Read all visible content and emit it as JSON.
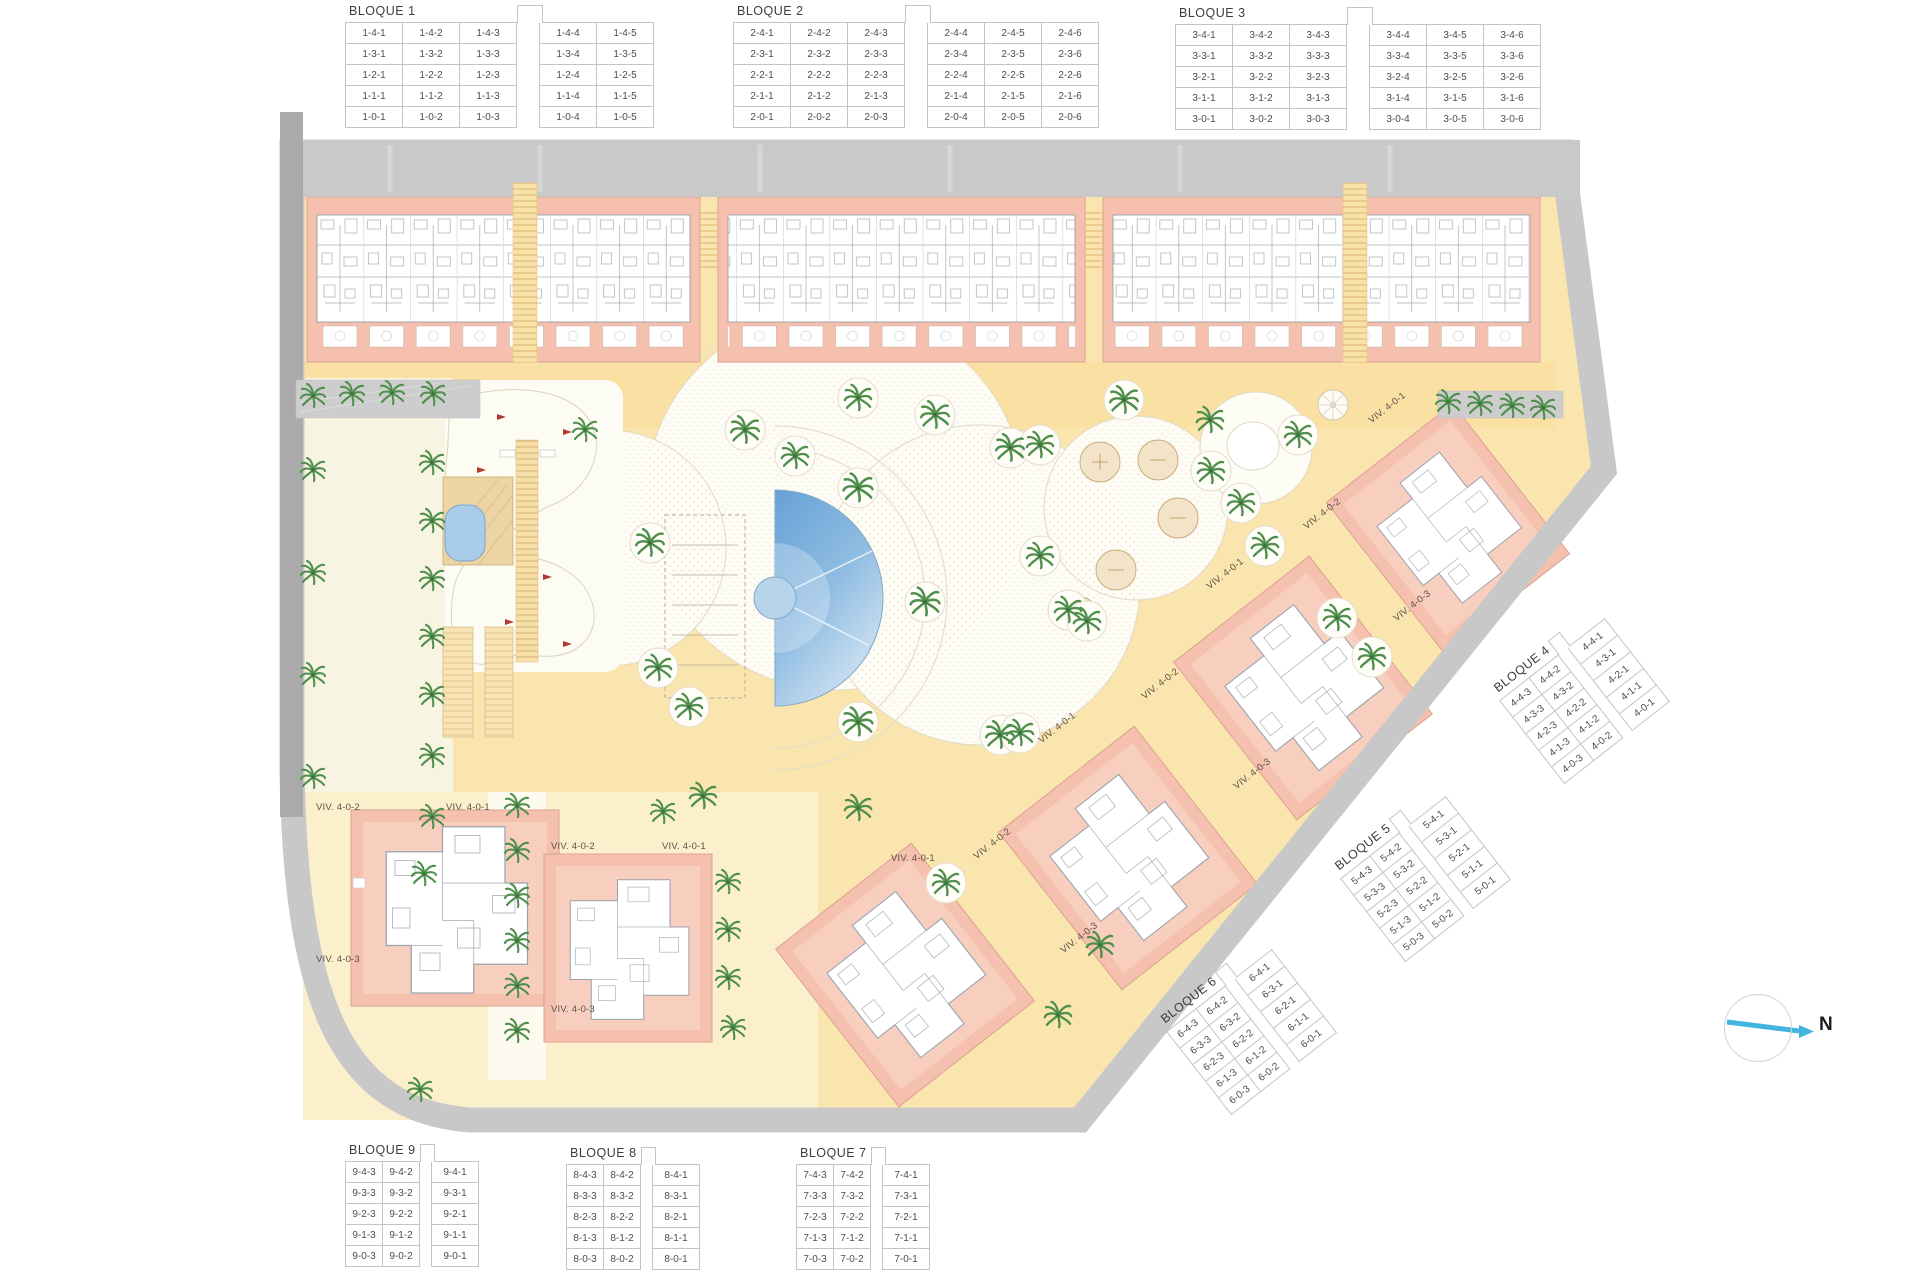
{
  "compass": {
    "label": "N",
    "icon": "north-arrow-icon"
  },
  "tables": [
    {
      "id": "bloque-1",
      "title": "BLOQUE 1",
      "gap_after": 3,
      "rows": [
        [
          "1-4-1",
          "1-4-2",
          "1-4-3",
          "1-4-4",
          "1-4-5"
        ],
        [
          "1-3-1",
          "1-3-2",
          "1-3-3",
          "1-3-4",
          "1-3-5"
        ],
        [
          "1-2-1",
          "1-2-2",
          "1-2-3",
          "1-2-4",
          "1-2-5"
        ],
        [
          "1-1-1",
          "1-1-2",
          "1-1-3",
          "1-1-4",
          "1-1-5"
        ],
        [
          "1-0-1",
          "1-0-2",
          "1-0-3",
          "1-0-4",
          "1-0-5"
        ]
      ]
    },
    {
      "id": "bloque-2",
      "title": "BLOQUE 2",
      "gap_after": 3,
      "rows": [
        [
          "2-4-1",
          "2-4-2",
          "2-4-3",
          "2-4-4",
          "2-4-5",
          "2-4-6"
        ],
        [
          "2-3-1",
          "2-3-2",
          "2-3-3",
          "2-3-4",
          "2-3-5",
          "2-3-6"
        ],
        [
          "2-2-1",
          "2-2-2",
          "2-2-3",
          "2-2-4",
          "2-2-5",
          "2-2-6"
        ],
        [
          "2-1-1",
          "2-1-2",
          "2-1-3",
          "2-1-4",
          "2-1-5",
          "2-1-6"
        ],
        [
          "2-0-1",
          "2-0-2",
          "2-0-3",
          "2-0-4",
          "2-0-5",
          "2-0-6"
        ]
      ]
    },
    {
      "id": "bloque-3",
      "title": "BLOQUE 3",
      "gap_after": 3,
      "rows": [
        [
          "3-4-1",
          "3-4-2",
          "3-4-3",
          "3-4-4",
          "3-4-5",
          "3-4-6"
        ],
        [
          "3-3-1",
          "3-3-2",
          "3-3-3",
          "3-3-4",
          "3-3-5",
          "3-3-6"
        ],
        [
          "3-2-1",
          "3-2-2",
          "3-2-3",
          "3-2-4",
          "3-2-5",
          "3-2-6"
        ],
        [
          "3-1-1",
          "3-1-2",
          "3-1-3",
          "3-1-4",
          "3-1-5",
          "3-1-6"
        ],
        [
          "3-0-1",
          "3-0-2",
          "3-0-3",
          "3-0-4",
          "3-0-5",
          "3-0-6"
        ]
      ]
    },
    {
      "id": "bloque-4",
      "title": "BLOQUE 4",
      "gap_after": 2,
      "rows": [
        [
          "4-4-3",
          "4-4-2",
          "4-4-1"
        ],
        [
          "4-3-3",
          "4-3-2",
          "4-3-1"
        ],
        [
          "4-2-3",
          "4-2-2",
          "4-2-1"
        ],
        [
          "4-1-3",
          "4-1-2",
          "4-1-1"
        ],
        [
          "4-0-3",
          "4-0-2",
          "4-0-1"
        ]
      ]
    },
    {
      "id": "bloque-5",
      "title": "BLOQUE 5",
      "gap_after": 2,
      "rows": [
        [
          "5-4-3",
          "5-4-2",
          "5-4-1"
        ],
        [
          "5-3-3",
          "5-3-2",
          "5-3-1"
        ],
        [
          "5-2-3",
          "5-2-2",
          "5-2-1"
        ],
        [
          "5-1-3",
          "5-1-2",
          "5-1-1"
        ],
        [
          "5-0-3",
          "5-0-2",
          "5-0-1"
        ]
      ]
    },
    {
      "id": "bloque-6",
      "title": "BLOQUE 6",
      "gap_after": 2,
      "rows": [
        [
          "6-4-3",
          "6-4-2",
          "6-4-1"
        ],
        [
          "6-3-3",
          "6-3-2",
          "6-3-1"
        ],
        [
          "6-2-3",
          "6-2-2",
          "6-2-1"
        ],
        [
          "6-1-3",
          "6-1-2",
          "6-1-1"
        ],
        [
          "6-0-3",
          "6-0-2",
          "6-0-1"
        ]
      ]
    },
    {
      "id": "bloque-7",
      "title": "BLOQUE 7",
      "gap_after": 2,
      "rows": [
        [
          "7-4-3",
          "7-4-2",
          "7-4-1"
        ],
        [
          "7-3-3",
          "7-3-2",
          "7-3-1"
        ],
        [
          "7-2-3",
          "7-2-2",
          "7-2-1"
        ],
        [
          "7-1-3",
          "7-1-2",
          "7-1-1"
        ],
        [
          "7-0-3",
          "7-0-2",
          "7-0-1"
        ]
      ]
    },
    {
      "id": "bloque-8",
      "title": "BLOQUE 8",
      "gap_after": 2,
      "rows": [
        [
          "8-4-3",
          "8-4-2",
          "8-4-1"
        ],
        [
          "8-3-3",
          "8-3-2",
          "8-3-1"
        ],
        [
          "8-2-3",
          "8-2-2",
          "8-2-1"
        ],
        [
          "8-1-3",
          "8-1-2",
          "8-1-1"
        ],
        [
          "8-0-3",
          "8-0-2",
          "8-0-1"
        ]
      ]
    },
    {
      "id": "bloque-9",
      "title": "BLOQUE 9",
      "gap_after": 2,
      "rows": [
        [
          "9-4-3",
          "9-4-2",
          "9-4-1"
        ],
        [
          "9-3-3",
          "9-3-2",
          "9-3-1"
        ],
        [
          "9-2-3",
          "9-2-2",
          "9-2-1"
        ],
        [
          "9-1-3",
          "9-1-2",
          "9-1-1"
        ],
        [
          "9-0-3",
          "9-0-2",
          "9-0-1"
        ]
      ]
    }
  ],
  "viv_labels": [
    {
      "text": "VIV. 4-0-2",
      "x": 316,
      "y": 802,
      "r": 0
    },
    {
      "text": "VIV. 4-0-1",
      "x": 446,
      "y": 802,
      "r": 0
    },
    {
      "text": "VIV. 4-0-3",
      "x": 316,
      "y": 954,
      "r": 0
    },
    {
      "text": "VIV. 4-0-2",
      "x": 551,
      "y": 841,
      "r": 0
    },
    {
      "text": "VIV. 4-0-1",
      "x": 662,
      "y": 841,
      "r": 0
    },
    {
      "text": "VIV. 4-0-3",
      "x": 551,
      "y": 1004,
      "r": 0
    },
    {
      "text": "VIV. 4-0-1",
      "x": 891,
      "y": 853,
      "r": 0
    },
    {
      "text": "VIV. 4-0-2",
      "x": 975,
      "y": 852,
      "r": -38
    },
    {
      "text": "VIV. 4-0-3",
      "x": 1062,
      "y": 946,
      "r": -38
    },
    {
      "text": "VIV. 4-0-1",
      "x": 1040,
      "y": 736,
      "r": -38
    },
    {
      "text": "VIV. 4-0-2",
      "x": 1143,
      "y": 692,
      "r": -38
    },
    {
      "text": "VIV. 4-0-3",
      "x": 1235,
      "y": 782,
      "r": -38
    },
    {
      "text": "VIV. 4-0-1",
      "x": 1208,
      "y": 582,
      "r": -38
    },
    {
      "text": "VIV. 4-0-2",
      "x": 1305,
      "y": 522,
      "r": -38
    },
    {
      "text": "VIV. 4-0-3",
      "x": 1395,
      "y": 614,
      "r": -38
    },
    {
      "text": "VIV. 4-0-1",
      "x": 1370,
      "y": 416,
      "r": -38
    }
  ],
  "icons": {
    "palm": "palm-tree-icon",
    "flag": "golf-flag-icon",
    "compass": "north-arrow-icon"
  },
  "colors": {
    "building_salmon": "#f5c1ae",
    "path_yellow": "#fbe5ae",
    "promenade_yellow": "#fae1a3",
    "plaza_white": "#fdfcf5",
    "ivory": "#f8f4e2",
    "pool_blue": "#6ca6d8",
    "road_gray": "#c8c8c8",
    "palm_green": "#4f8f4c",
    "flag_red": "#b23a32",
    "compass_blue": "#41b5de"
  }
}
